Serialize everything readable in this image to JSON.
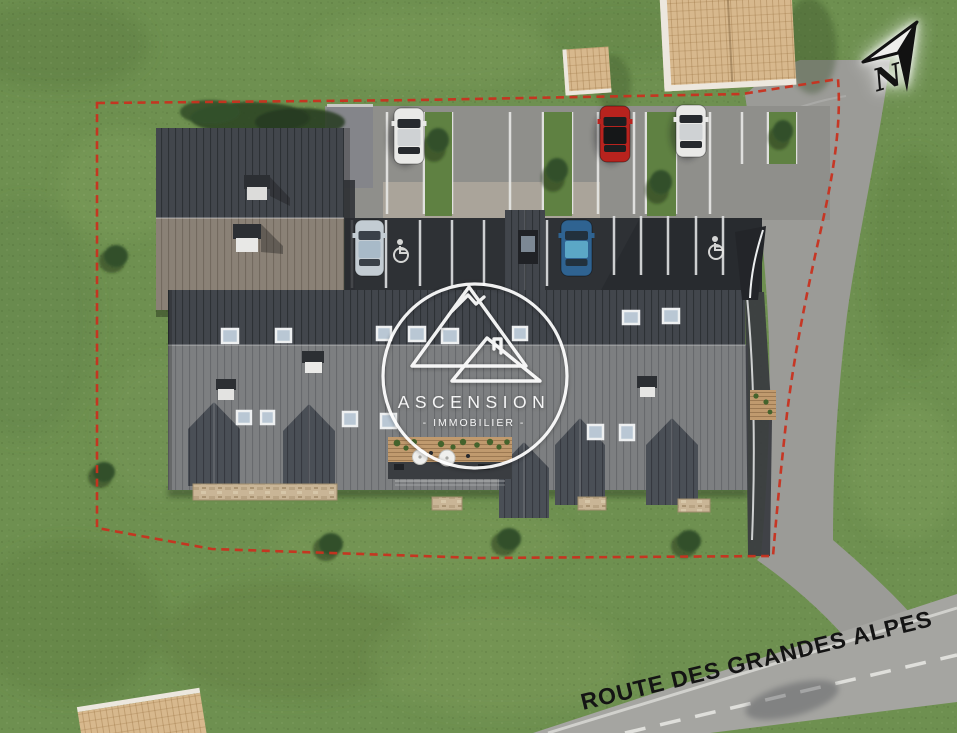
{
  "watermark": {
    "title": "ASCENSION",
    "subtitle": "IMMOBILIER",
    "subtitle_display": "-  IMMOBILIER  -",
    "logo": "circle with two overlapping mountain/roof triangle outlines",
    "color": "#ffffff"
  },
  "road": {
    "label": "ROUTE DES GRANDES ALPES",
    "label_color": "#141414",
    "surface_color": "#a5a5a1",
    "centerline": "white dashed"
  },
  "compass": {
    "letter": "N",
    "style": "black arrow pointing up-right with white glow"
  },
  "boundary": {
    "color": "#c8311f",
    "style": "red dashed property line"
  },
  "colors": {
    "grass": "#6e9050",
    "roof_dark": "#42464c",
    "roof_gray": "#7d7f81",
    "roof_brown": "#8a8176",
    "asphalt": "#8f8f8b",
    "driveway": "#9b9b97",
    "carport_ground": "#2e3135",
    "shingle_tan": "#d7b88d",
    "stone_wall": "#c9b596",
    "skylight_glass": "#b9c7d4",
    "parking_line": "#e8e8e6"
  },
  "cars": [
    {
      "name": "white-car-top-row",
      "color": "white",
      "hex": "#e9e9e7"
    },
    {
      "name": "red-car-top-row",
      "color": "red",
      "hex": "#b8231e"
    },
    {
      "name": "white-car-top-row-right",
      "color": "white",
      "hex": "#e9e9e7"
    },
    {
      "name": "silver-car-carport",
      "color": "silver",
      "hex": "#c3ccd3"
    },
    {
      "name": "blue-car-carport",
      "color": "blue",
      "hex": "#2f6391"
    }
  ],
  "markings": {
    "handicap_spots": 2,
    "parking_rows": 2
  }
}
